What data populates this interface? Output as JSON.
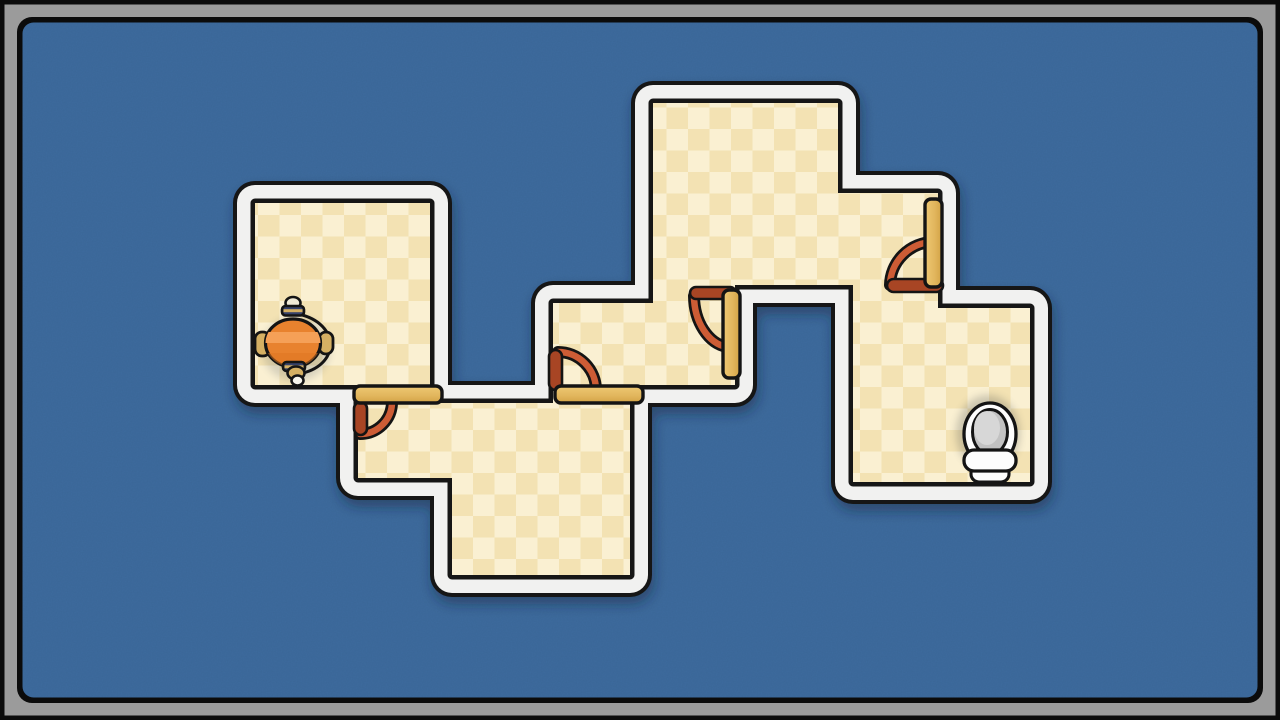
{
  "canvas": {
    "width": 1280,
    "height": 720
  },
  "frame": {
    "outer_border_px": 4.5,
    "band_px": 13,
    "inner_border_px": 5.5,
    "corner_radius": 15
  },
  "palette": {
    "outline": "#141414",
    "bg": "#3d6b9e",
    "wall": "#f1f1f0",
    "frame_band": "#9b9b9b",
    "frame_dark": "#0b0b0b",
    "floor_a": "#faf0d2",
    "floor_b": "#f3e2b3",
    "door_hi": "#eec873",
    "door": "#e2b75e",
    "door_lo": "#d2a245",
    "swing": "#cd5c35",
    "swing_dark": "#a84524",
    "char_body": "#e8822e",
    "char_band": "#f5a057",
    "char_low": "#de7623",
    "char_navy": "#36426b",
    "char_gold": "#d5b063",
    "char_cream": "#f0ead6",
    "char_tip": "#f7f5ec",
    "toilet_white": "#fdfdfd",
    "toilet_gray": "#c2c2c2",
    "toilet_gray_light": "#d7d7d7",
    "shadow": "#16263c"
  },
  "floor": {
    "checker_size": 21.5,
    "outline_points": [
      [
        255,
        203
      ],
      [
        430,
        203
      ],
      [
        430,
        403
      ],
      [
        553,
        403
      ],
      [
        553,
        303
      ],
      [
        653,
        303
      ],
      [
        653,
        103
      ],
      [
        838,
        103
      ],
      [
        838,
        193
      ],
      [
        938,
        193
      ],
      [
        938,
        308
      ],
      [
        1030,
        308
      ],
      [
        1030,
        482
      ],
      [
        853,
        482
      ],
      [
        853,
        285
      ],
      [
        735,
        285
      ],
      [
        735,
        385
      ],
      [
        630,
        385
      ],
      [
        630,
        575
      ],
      [
        452,
        575
      ],
      [
        452,
        478
      ],
      [
        358,
        478
      ],
      [
        358,
        385
      ],
      [
        255,
        385
      ]
    ]
  },
  "rooms": [
    {
      "id": "top-left-room",
      "bounds": [
        255,
        203,
        430,
        385
      ],
      "contains": "character"
    },
    {
      "id": "bottom-room",
      "bounds": [
        358,
        403,
        630,
        575
      ],
      "shape": "L (notch at bottom-left below y478 left of x452)"
    },
    {
      "id": "middle-room",
      "bounds": [
        553,
        303,
        735,
        385
      ]
    },
    {
      "id": "top-room",
      "bounds": [
        653,
        103,
        938,
        285
      ],
      "shape": "L (right extension x838-938 starts at y193)"
    },
    {
      "id": "toilet-room",
      "bounds": [
        853,
        308,
        1030,
        482
      ],
      "contains": "toilet"
    }
  ],
  "doors": [
    {
      "id": "door-1",
      "state": "closed",
      "orientation": "horizontal",
      "connects": [
        "top-left-room",
        "bottom-room"
      ],
      "bar": {
        "x": 354,
        "y": 386,
        "w": 88,
        "h": 17,
        "rx": 6
      },
      "stub": {
        "x": 354,
        "y": 402,
        "w": 13,
        "h": 33,
        "rx": 6.5
      },
      "arc": {
        "sx": 392,
        "sy": 402,
        "ex": 360,
        "ey": 434,
        "rx": 32,
        "ry": 32,
        "sweep": 1
      }
    },
    {
      "id": "door-2",
      "state": "closed",
      "orientation": "horizontal",
      "connects": [
        "bottom-room",
        "middle-room"
      ],
      "bar": {
        "x": 555,
        "y": 386,
        "w": 88,
        "h": 17,
        "rx": 6
      },
      "stub": {
        "x": 549,
        "y": 350,
        "w": 13,
        "h": 40,
        "rx": 6.5
      },
      "arc": {
        "sx": 558,
        "sy": 352,
        "ex": 596,
        "ey": 390,
        "rx": 38,
        "ry": 38,
        "sweep": 1
      }
    },
    {
      "id": "door-3",
      "state": "open",
      "orientation": "vertical",
      "connects": [
        "middle-room",
        "top-room"
      ],
      "bar": {
        "x": 723,
        "y": 290,
        "w": 17,
        "h": 88,
        "rx": 6
      },
      "stub": {
        "x": 690,
        "y": 287,
        "w": 46,
        "h": 12,
        "rx": 6
      },
      "arc": {
        "sx": 694,
        "sy": 296,
        "ex": 727,
        "ey": 347,
        "rx": 38,
        "ry": 52,
        "sweep": 0
      }
    },
    {
      "id": "door-4",
      "state": "open",
      "orientation": "vertical",
      "connects": [
        "top-room",
        "toilet-room"
      ],
      "bar": {
        "x": 925,
        "y": 199,
        "w": 17,
        "h": 88,
        "rx": 6
      },
      "stub": {
        "x": 887,
        "y": 279,
        "w": 56,
        "h": 13,
        "rx": 6.5
      },
      "arc": {
        "sx": 890,
        "sy": 285,
        "ex": 933,
        "ey": 242,
        "rx": 44,
        "ry": 44,
        "sweep": 1
      }
    }
  ],
  "entities": {
    "character": {
      "x": 293,
      "y": 343,
      "description": "orange spinning-top character, top-down"
    },
    "toilet": {
      "x": 990,
      "y": 437,
      "description": "toilet goal, top-down"
    }
  }
}
